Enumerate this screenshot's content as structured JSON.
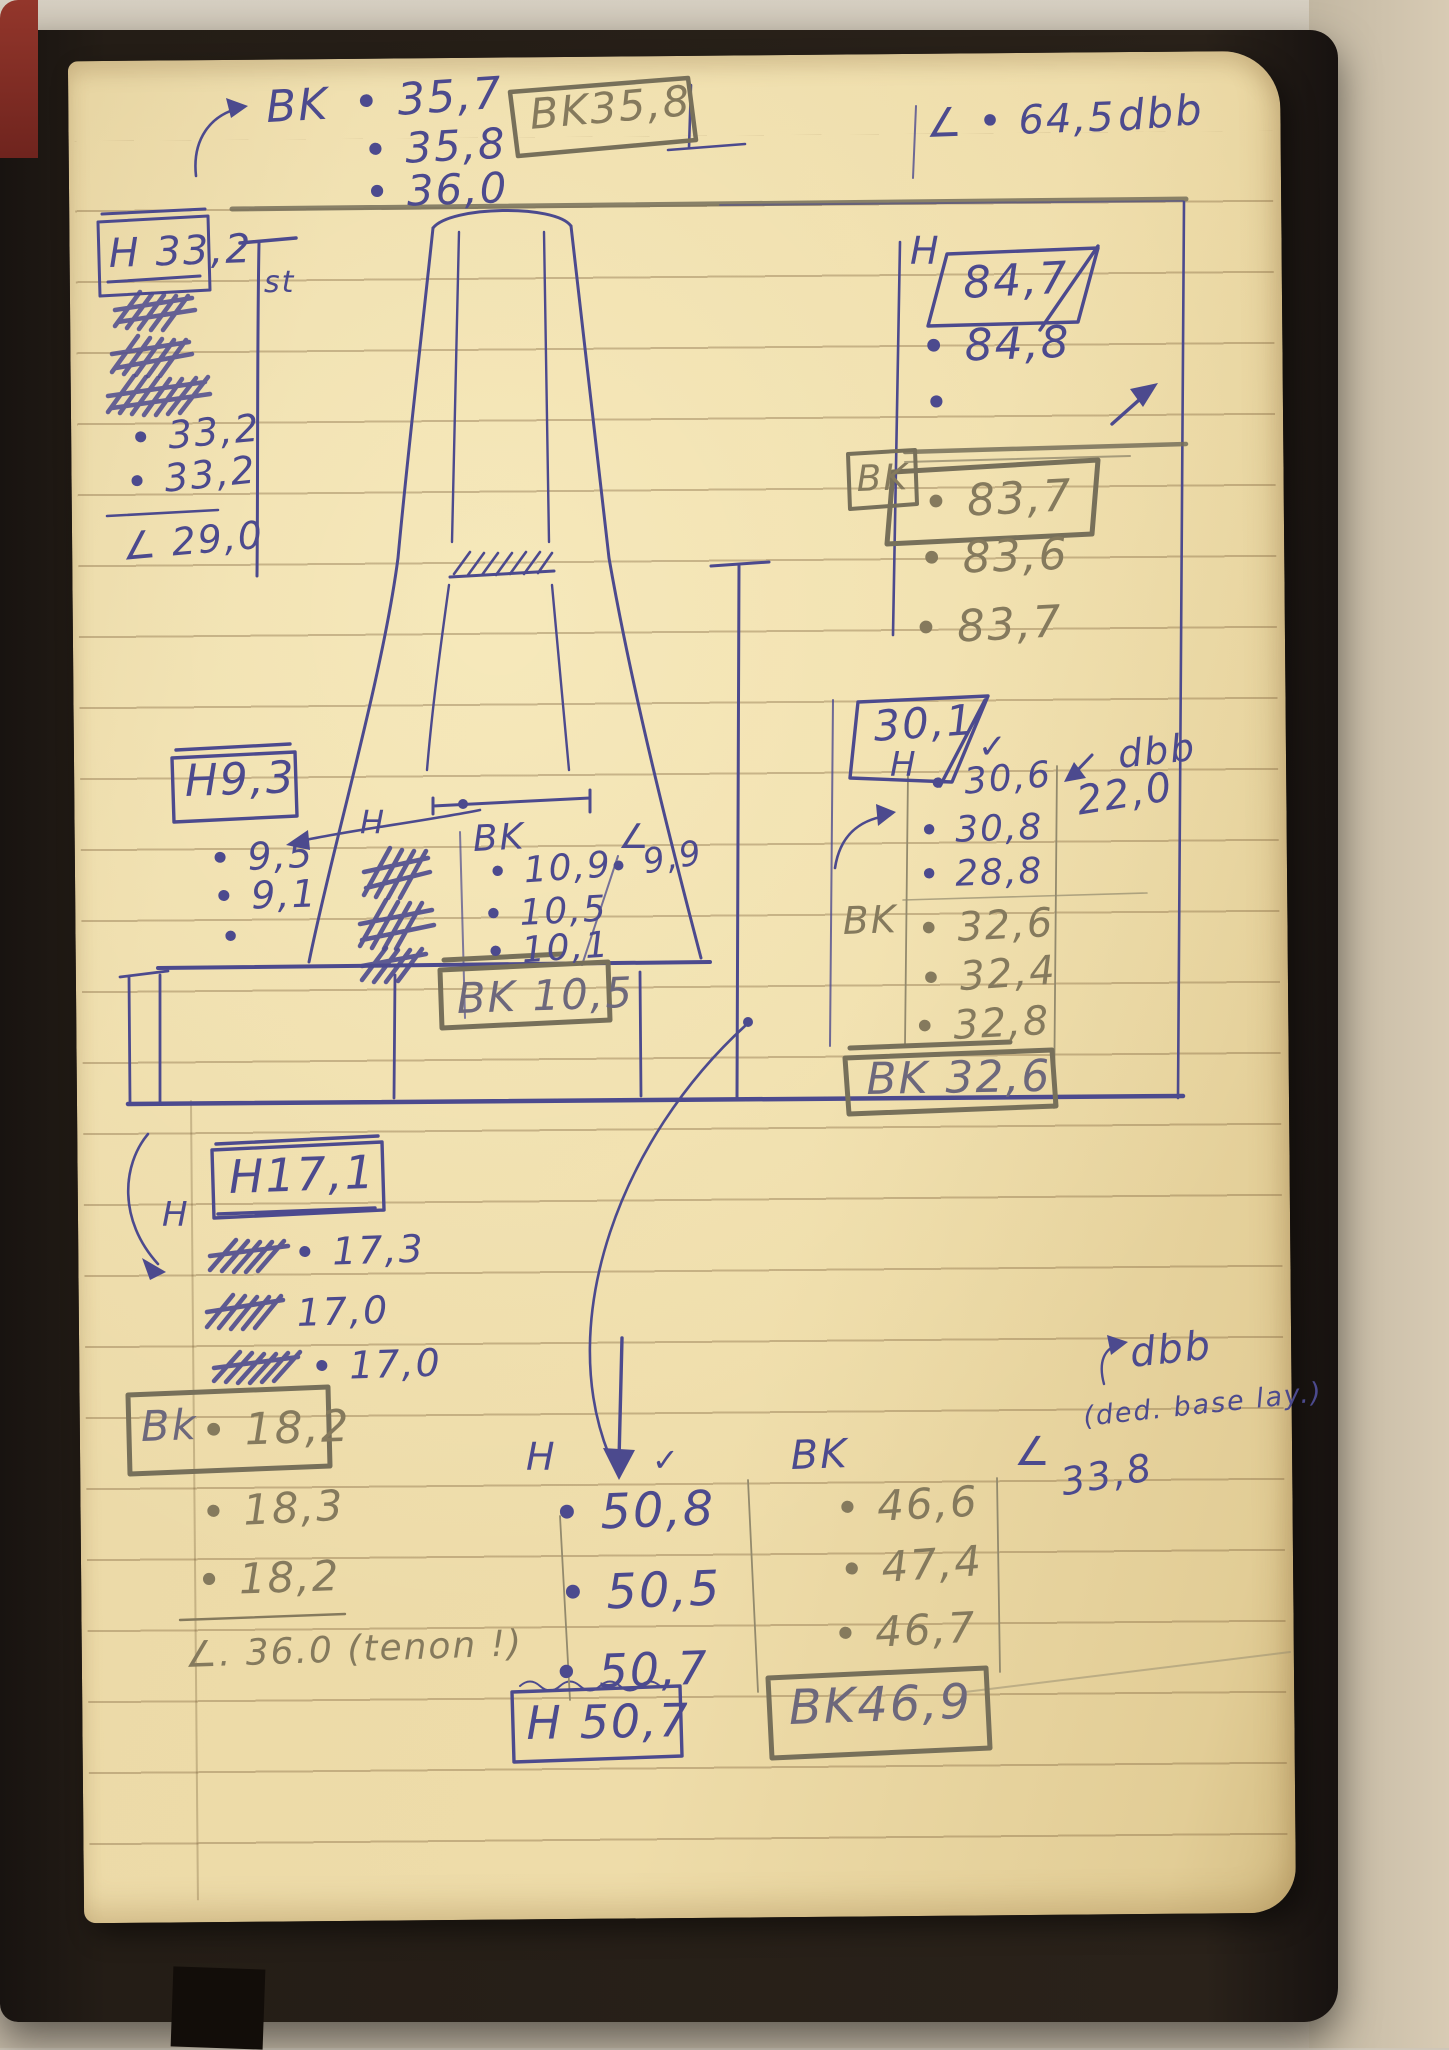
{
  "colors": {
    "ink_blue": "#4c4a8e",
    "pencil_gray": "#857a5d",
    "mixed_gray_blue": "#6d687c",
    "paper": "#ecdaa8"
  },
  "notes": {
    "top_bk": {
      "label": "BK",
      "v1": "• 35,7",
      "v2": "• 35,8",
      "v3": "• 36,0",
      "box": "BK35,8"
    },
    "top_angle": {
      "value": "∠ • 64,5",
      "unit": "dbb"
    },
    "h33": {
      "box": "H 33,2",
      "v1": "• 33,2",
      "v2": "• 33,2",
      "angle": "∠ 29,0"
    },
    "st_label": "st",
    "h84": {
      "label": "H",
      "box": "84,7",
      "v1": "• 84,8",
      "v2": "•"
    },
    "bk83": {
      "label": "BK",
      "box": "• 83,7",
      "v1": "• 83,6",
      "v2": "• 83,7"
    },
    "h30": {
      "box": "30,1",
      "check": "✓",
      "label": "H",
      "v1": "• 30,6",
      "v2": "• 30,8",
      "v3": "• 28,8"
    },
    "angle22": {
      "unit": "dbb",
      "value": "22,0"
    },
    "bk32": {
      "label": "BK",
      "v1": "• 32,6",
      "v2": "• 32,4",
      "v3": "• 32,8",
      "box": "BK 32,6"
    },
    "h9": {
      "box": "H9,3",
      "pointer": "H",
      "v1": "• 9,5",
      "v2": "• 9,1",
      "v3": "•"
    },
    "bk10": {
      "label": "BK",
      "v1": "• 10,9",
      "v2": "• 10,5",
      "v3": "• 10,1",
      "box": "BK 10,5"
    },
    "angle9": {
      "label": "∠",
      "value": "• 9,9"
    },
    "h17": {
      "pointer": "H",
      "box": "H17,1",
      "v1": "• 17,3",
      "v2": "17,0",
      "v3": "• 17,0"
    },
    "bk18": {
      "label": "Bk",
      "box_value": "• 18,2",
      "v1": "• 18,3",
      "v2": "• 18,2",
      "angle": "∠. 36.0 (tenon !)"
    },
    "h50": {
      "label": "H",
      "check": "✓",
      "v1": "• 50,8",
      "v2": "• 50,5",
      "v3": "• 50,7",
      "box": "H 50,7"
    },
    "bk46": {
      "label": "BK",
      "v1": "• 46,6",
      "v2": "• 47,4",
      "v3": "• 46,7",
      "box": "BK46,9"
    },
    "angle33": {
      "label": "∠",
      "value": "33,8",
      "unit": "dbb",
      "note": "(ded. base lay.)"
    }
  }
}
